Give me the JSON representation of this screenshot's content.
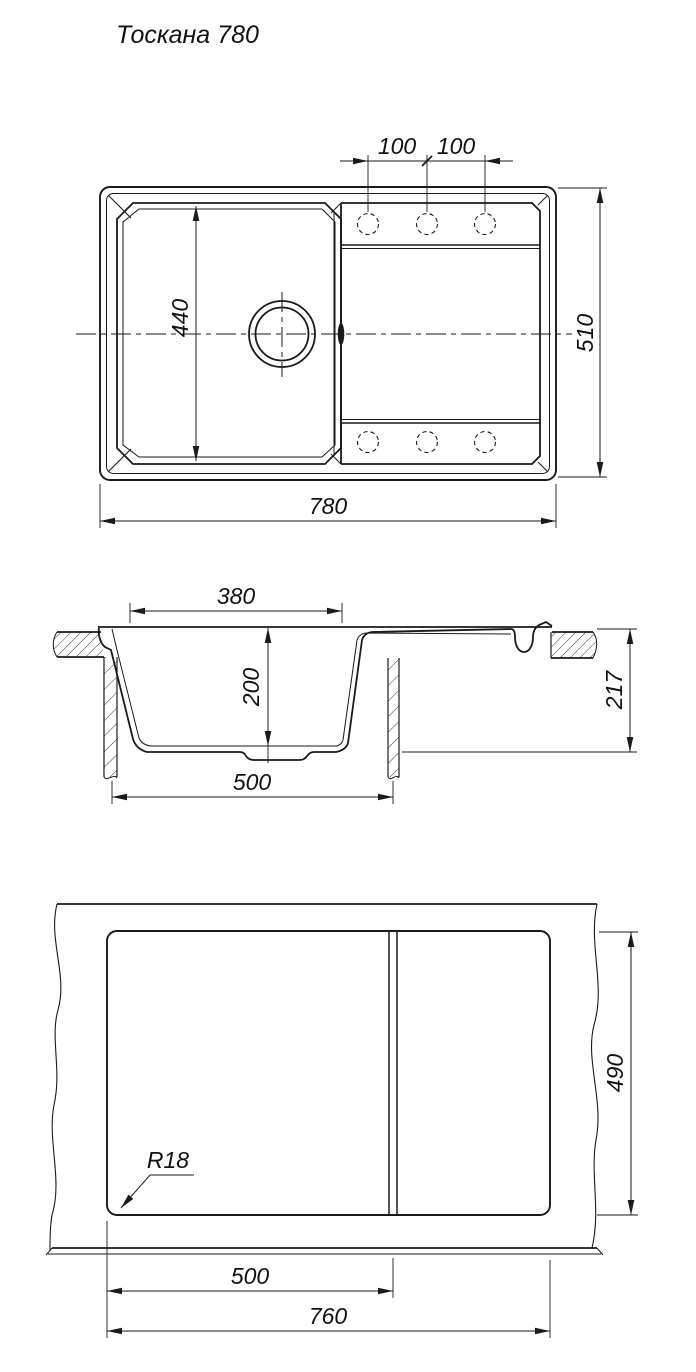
{
  "title": "Тоскана 780",
  "ink_color": "#1a1a1a",
  "top_view": {
    "hole_pitch_left": "100",
    "hole_pitch_right": "100",
    "bowl_length": "440",
    "overall_depth": "510",
    "overall_length": "780",
    "tap_holes_per_band": 3
  },
  "section_view": {
    "bowl_top_width": "380",
    "bowl_depth": "200",
    "bowl_bottom_width": "500",
    "overall_height": "217"
  },
  "cutout_view": {
    "cutout_height": "490",
    "bowl_section_width": "500",
    "cutout_width": "760",
    "corner_radius": "R18"
  }
}
